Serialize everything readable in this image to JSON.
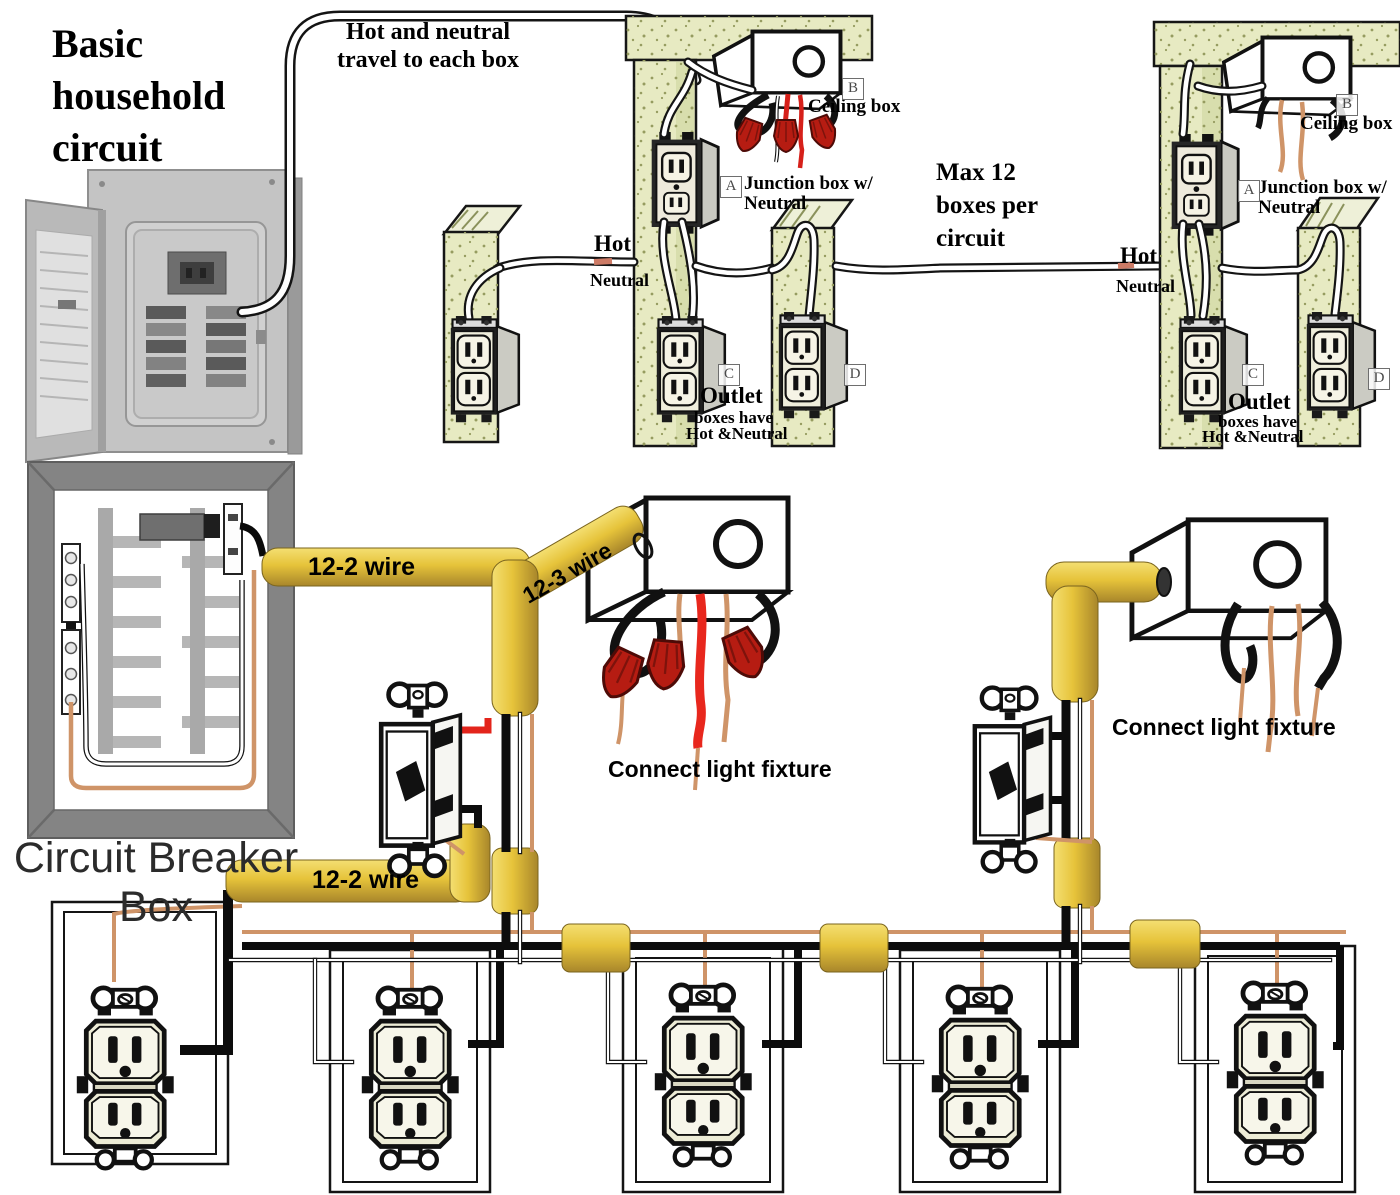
{
  "title": "Basic\nhousehold\ncircuit",
  "notes": {
    "travel": "Hot and neutral\ntravel to each box",
    "max_boxes": "Max 12\nboxes per\ncircuit"
  },
  "wall_left": {
    "hot": "Hot",
    "neutral": "Neutral",
    "badge_a": "A",
    "badge_b": "B",
    "badge_c": "C",
    "badge_d": "D",
    "ceiling_box": "Ceiling box",
    "junction_box": "Junction box w/\nNeutral",
    "outlet_note_1": "Outlet",
    "outlet_note_2": "boxes have",
    "outlet_note_3": "Hot &Neutral"
  },
  "wall_right": {
    "hot": "Hot",
    "neutral": "Neutral",
    "badge_a": "A",
    "badge_b": "B",
    "badge_c": "C",
    "badge_d": "D",
    "ceiling_box": "Ceiling box",
    "junction_box": "Junction box w/\nNeutral",
    "outlet_note_1": "Outlet",
    "outlet_note_2": "boxes have",
    "outlet_note_3": "Hot &Neutral"
  },
  "breaker_box": {
    "label": "Circuit Breaker Box"
  },
  "cables": {
    "top_12_2": "12-2 wire",
    "diag_12_3": "12-3 wire",
    "bottom_12_2": "12-2 wire"
  },
  "fixtures": {
    "connect_left": "Connect light fixture",
    "connect_right": "Connect light fixture"
  },
  "colors": {
    "cable_yellow": "#e6c33a",
    "wire_red": "#e3241b",
    "wire_copper": "#cf9468",
    "stud_khaki": "#e7eac2",
    "wirenut_red": "#b61c12"
  }
}
